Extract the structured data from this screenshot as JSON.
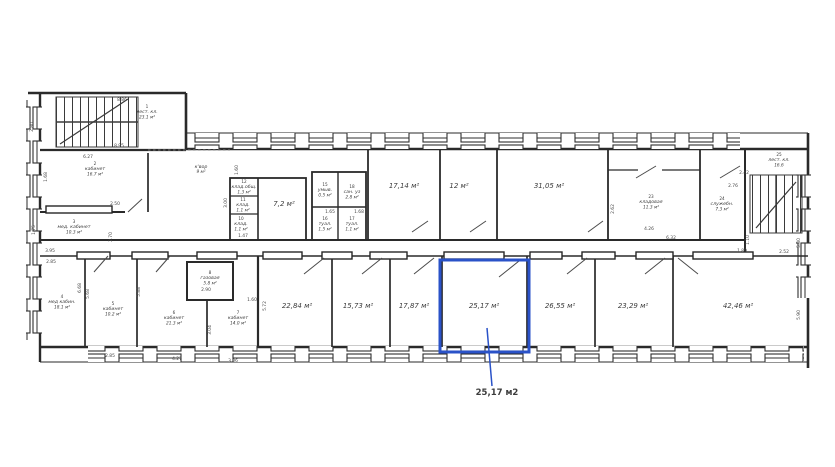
{
  "highlight": {
    "label": "25,17 м2",
    "color": "#2a52c8",
    "room_area": "25,17 м²"
  },
  "floor_plan": {
    "rooms": [
      {
        "num": "1",
        "name": "лест. кл.",
        "area": "23.1 м²",
        "x": 147,
        "y": 108
      },
      {
        "num": "2",
        "name": "кабинет",
        "area": "16.7 м²",
        "x": 95,
        "y": 165
      },
      {
        "num": "3",
        "name": "мед. кабинет",
        "area": "10.3 м²",
        "x": 74,
        "y": 223
      },
      {
        "num": "4",
        "name": "мед кабин.",
        "area": "18.1 м²",
        "x": 62,
        "y": 298
      },
      {
        "num": "5",
        "name": "кабинет",
        "area": "10.2 м²",
        "x": 113,
        "y": 305
      },
      {
        "num": "6",
        "name": "кабинет",
        "area": "21.3 м²",
        "x": 174,
        "y": 314
      },
      {
        "num": "7",
        "name": "кабинет",
        "area": "14.0 м²",
        "x": 238,
        "y": 314
      },
      {
        "num": "8",
        "name": "газовая",
        "area": "5.8 м²",
        "x": 210,
        "y": 274
      },
      {
        "num": "",
        "name": "к'вор",
        "area": "9 м²",
        "x": 201,
        "y": 168
      },
      {
        "num": "12",
        "name": "клад.общ.",
        "area": "1.3 м²",
        "x": 244,
        "y": 183
      },
      {
        "num": "11",
        "name": "клад.",
        "area": "1.1 м²",
        "x": 243,
        "y": 201
      },
      {
        "num": "10",
        "name": "клад.",
        "area": "1.1 м²",
        "x": 241,
        "y": 220
      },
      {
        "num": "",
        "name": "",
        "area": "7,2 м²",
        "x": 284,
        "y": 206,
        "big": 1
      },
      {
        "num": "15",
        "name": "умыв.",
        "area": "0.5 м²",
        "x": 325,
        "y": 186
      },
      {
        "num": "18",
        "name": "сан. уз",
        "area": "2.8 м²",
        "x": 352,
        "y": 188
      },
      {
        "num": "16",
        "name": "туал.",
        "area": "1.5 м²",
        "x": 325,
        "y": 220
      },
      {
        "num": "17",
        "name": "туал.",
        "area": "1.1 м²",
        "x": 352,
        "y": 220
      },
      {
        "num": "",
        "name": "",
        "area": "17,14 м²",
        "x": 404,
        "y": 188,
        "big": 1
      },
      {
        "num": "",
        "name": "",
        "area": "12 м²",
        "x": 459,
        "y": 188,
        "big": 1
      },
      {
        "num": "",
        "name": "",
        "area": "31,05 м²",
        "x": 549,
        "y": 188,
        "big": 1
      },
      {
        "num": "23",
        "name": "кладовая",
        "area": "11.3 м²",
        "x": 651,
        "y": 198
      },
      {
        "num": "24",
        "name": "служебн.",
        "area": "7.3 м²",
        "x": 722,
        "y": 200
      },
      {
        "num": "25",
        "name": "лест. кл.",
        "area": "16.6",
        "x": 779,
        "y": 156
      },
      {
        "num": "",
        "name": "",
        "area": "22,84 м²",
        "x": 297,
        "y": 308,
        "big": 1
      },
      {
        "num": "",
        "name": "",
        "area": "15,73 м²",
        "x": 358,
        "y": 308,
        "big": 1
      },
      {
        "num": "",
        "name": "",
        "area": "17,87 м²",
        "x": 414,
        "y": 308,
        "big": 1
      },
      {
        "num": "",
        "name": "",
        "area": "25,17 м²",
        "x": 484,
        "y": 308,
        "big": 1
      },
      {
        "num": "",
        "name": "",
        "area": "26,55 м²",
        "x": 560,
        "y": 308,
        "big": 1
      },
      {
        "num": "",
        "name": "",
        "area": "23,29 м²",
        "x": 633,
        "y": 308,
        "big": 1
      },
      {
        "num": "",
        "name": "",
        "area": "42,46 м²",
        "x": 738,
        "y": 308,
        "big": 1
      }
    ],
    "dimensions": [
      {
        "t": "8.86",
        "x": 122,
        "y": 101
      },
      {
        "t": "8.95",
        "x": 119,
        "y": 147
      },
      {
        "t": "2.80",
        "x": 33,
        "y": 127,
        "r": -90
      },
      {
        "t": "6.27",
        "x": 88,
        "y": 158
      },
      {
        "t": "1.68",
        "x": 47,
        "y": 177,
        "r": -90
      },
      {
        "t": "2.50",
        "x": 115,
        "y": 205
      },
      {
        "t": "2.70",
        "x": 112,
        "y": 237,
        "r": -90
      },
      {
        "t": "1.75",
        "x": 35,
        "y": 230,
        "r": -90
      },
      {
        "t": "3.95",
        "x": 50,
        "y": 252
      },
      {
        "t": "2.85",
        "x": 51,
        "y": 263
      },
      {
        "t": "1.60",
        "x": 238,
        "y": 170,
        "r": -90
      },
      {
        "t": "3.00",
        "x": 227,
        "y": 203,
        "r": -90
      },
      {
        "t": "1.47",
        "x": 243,
        "y": 237
      },
      {
        "t": "1.65",
        "x": 330,
        "y": 213
      },
      {
        "t": "1.68",
        "x": 359,
        "y": 213
      },
      {
        "t": "6.68",
        "x": 81,
        "y": 288,
        "r": -90
      },
      {
        "t": "5.68",
        "x": 89,
        "y": 294,
        "r": -90
      },
      {
        "t": "5.88",
        "x": 140,
        "y": 292,
        "r": -90
      },
      {
        "t": "2.90",
        "x": 206,
        "y": 291
      },
      {
        "t": "1.60",
        "x": 252,
        "y": 301
      },
      {
        "t": "5.72",
        "x": 266,
        "y": 306,
        "r": -90
      },
      {
        "t": "3.04",
        "x": 211,
        "y": 330,
        "r": -90
      },
      {
        "t": "2.85",
        "x": 110,
        "y": 357
      },
      {
        "t": "4.27",
        "x": 177,
        "y": 360
      },
      {
        "t": "3.06",
        "x": 233,
        "y": 362
      },
      {
        "t": "2.62",
        "x": 614,
        "y": 209,
        "r": -90
      },
      {
        "t": "2.76",
        "x": 733,
        "y": 187
      },
      {
        "t": "2.42",
        "x": 744,
        "y": 174
      },
      {
        "t": "4.26",
        "x": 649,
        "y": 230
      },
      {
        "t": "6.32",
        "x": 671,
        "y": 239
      },
      {
        "t": "1.89",
        "x": 742,
        "y": 252
      },
      {
        "t": "1.10",
        "x": 749,
        "y": 240,
        "r": -90
      },
      {
        "t": "2.52",
        "x": 784,
        "y": 253
      },
      {
        "t": "5.80",
        "x": 800,
        "y": 243,
        "r": -90
      },
      {
        "t": "5.90",
        "x": 800,
        "y": 315,
        "r": -90
      }
    ]
  }
}
